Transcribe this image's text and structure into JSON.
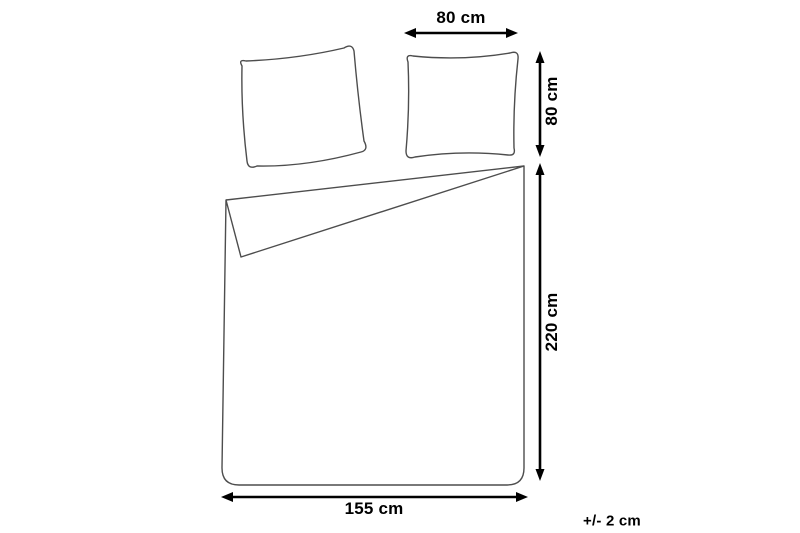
{
  "diagram": {
    "title": "bedding-dimensions-diagram",
    "labels": {
      "pillow_width": "80 cm",
      "pillow_height": "80 cm",
      "duvet_length": "220 cm",
      "duvet_width": "155 cm",
      "tolerance": "+/- 2 cm"
    },
    "colors": {
      "line": "#000000",
      "outline": "#4d4d4d",
      "background": "#ffffff"
    }
  }
}
